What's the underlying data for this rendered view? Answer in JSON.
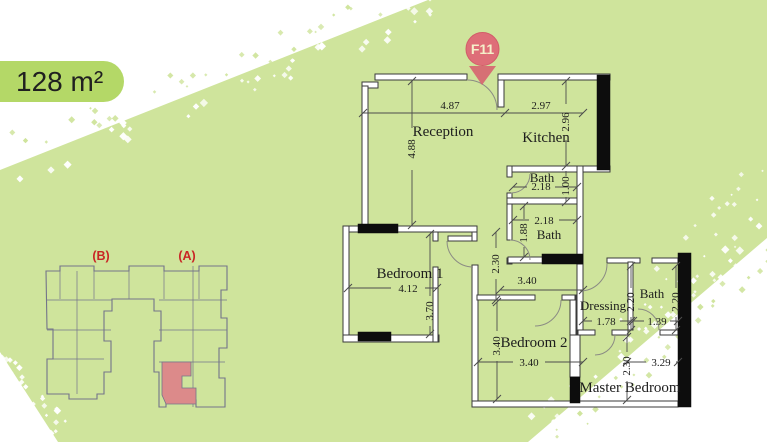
{
  "badge": {
    "area": "128 m²"
  },
  "marker": {
    "label": "F11"
  },
  "minimap": {
    "block_b_label": "(B)",
    "block_a_label": "(A)"
  },
  "plan": {
    "rooms": {
      "reception": "Reception",
      "kitchen": "Kitchen",
      "bath_top": "Bath",
      "bath_mid": "Bath",
      "bedroom1": "Bedroom 1",
      "bedroom2": "Bedroom 2",
      "dressing": "Dressing",
      "bath_right": "Bath",
      "master": "Master Bedroom"
    },
    "dims": {
      "reception_w": "4.87",
      "reception_h": "4.88",
      "kitchen_w": "2.97",
      "kitchen_h": "2.96",
      "bath_top_w": "2.18",
      "bath_top_h": "1.00",
      "bath_mid_w": "2.18",
      "bath_mid_h": "1.88",
      "hall_h": "2.30",
      "hall_w": "3.40",
      "bedroom1_w": "4.12",
      "bedroom1_h": "3.70",
      "bedroom2_h": "3.40",
      "bedroom2_w": "3.40",
      "dressing_w": "1.78",
      "dressing_h": "2.20",
      "bath_right_w": "1.39",
      "bath_right_h": "2.20",
      "master_h": "2.30",
      "master_w": "3.29"
    }
  },
  "colors": {
    "background_green": "#cfe49c",
    "pill_green": "#b4d867",
    "marker_pink": "#de6e78",
    "marker_text": "#f5f0ca",
    "marker_arrow": "#d7606e",
    "map_outline": "#74748a",
    "map_highlight": "#dc8a8a",
    "map_label_red": "#c92525",
    "wall_fill": "#ffffff",
    "line_dark": "#3a3a3a",
    "text_dark": "#1d1d1d"
  }
}
